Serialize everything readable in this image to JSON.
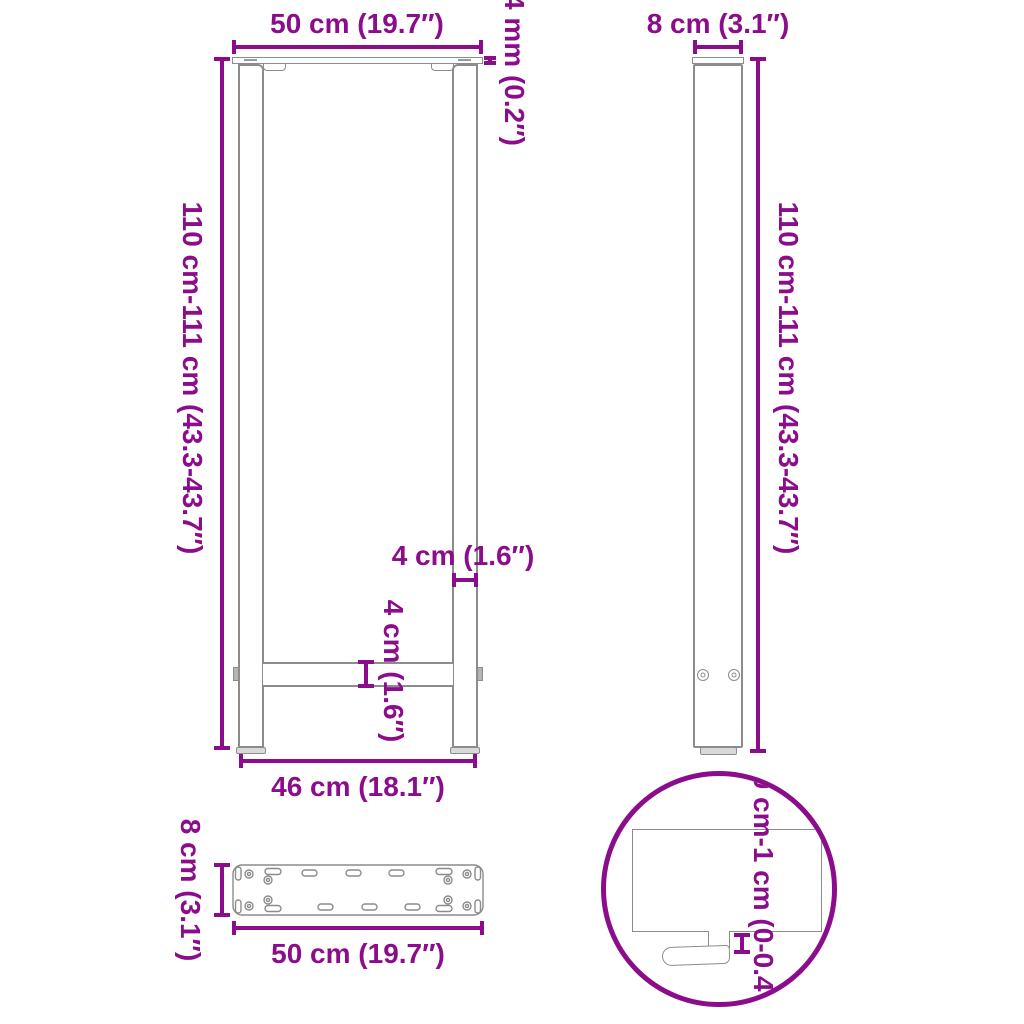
{
  "colors": {
    "dimension": "#8B0D8B",
    "outline": "#8C8C8C"
  },
  "views": {
    "front": {
      "dims": {
        "top_width": "50 cm (19.7″)",
        "plate_thickness": "4 mm (0.2″)",
        "height": "110 cm-111 cm (43.3-43.7″)",
        "leg_width": "4 cm (1.6″)",
        "crossbar_height": "4 cm (1.6″)",
        "bottom_width": "46 cm (18.1″)"
      }
    },
    "side": {
      "dims": {
        "top_width": "8 cm (3.1″)",
        "height": "110 cm-111 cm (43.3-43.7″)"
      }
    },
    "plate": {
      "dims": {
        "depth": "8 cm (3.1″)",
        "width": "50 cm (19.7″)"
      }
    },
    "detail": {
      "dims": {
        "foot_adjustment": "0 cm-1 cm (0-0.4″)"
      }
    }
  }
}
